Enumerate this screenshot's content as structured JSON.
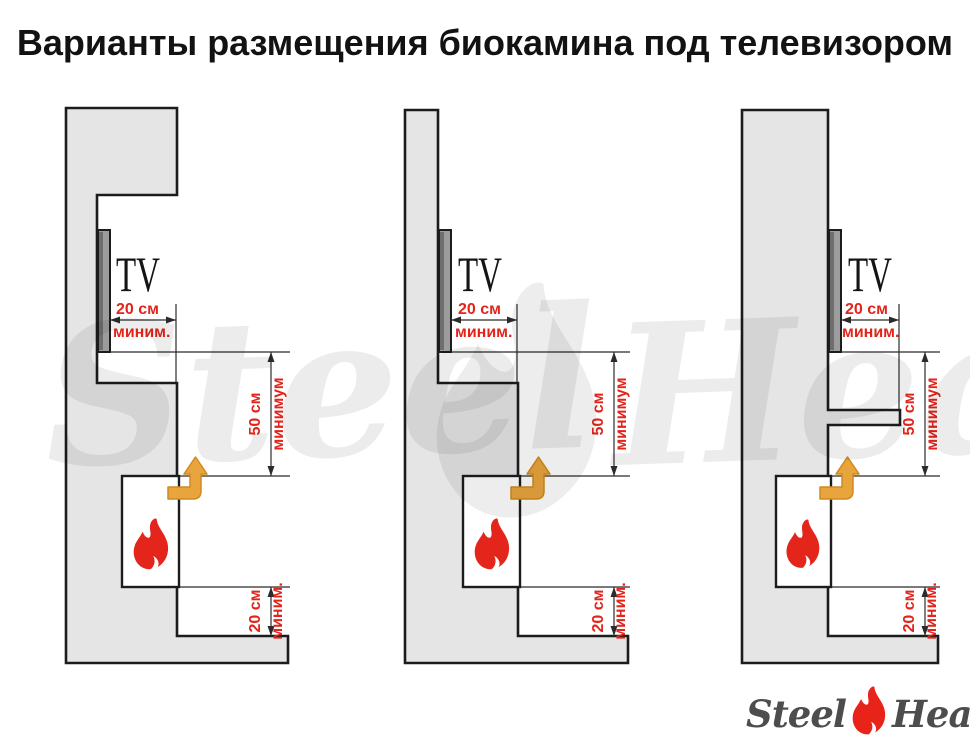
{
  "title": "Варианты размещения биокамина под телевизором",
  "watermark": {
    "steel": "Steel",
    "heat": "Heat"
  },
  "logo": {
    "steel": "Steel",
    "heat": "Heat"
  },
  "labels": {
    "tv": "TV",
    "gap_top_value": "20 см",
    "gap_top_qualifier": "миним.",
    "gap_side_value": "50 см",
    "gap_side_qualifier": "минимум",
    "gap_bottom_value": "20 см",
    "gap_bottom_qualifier": "миним."
  },
  "colors": {
    "wall_fill": "#e5e5e5",
    "outline": "#1c1c1c",
    "dimension_red": "#e2241b",
    "airflow_orange": "#e9a53d",
    "tv_gray": "#9c9c9c",
    "flame_red": "#e3251b",
    "logo_gray": "#4d4d4d"
  }
}
